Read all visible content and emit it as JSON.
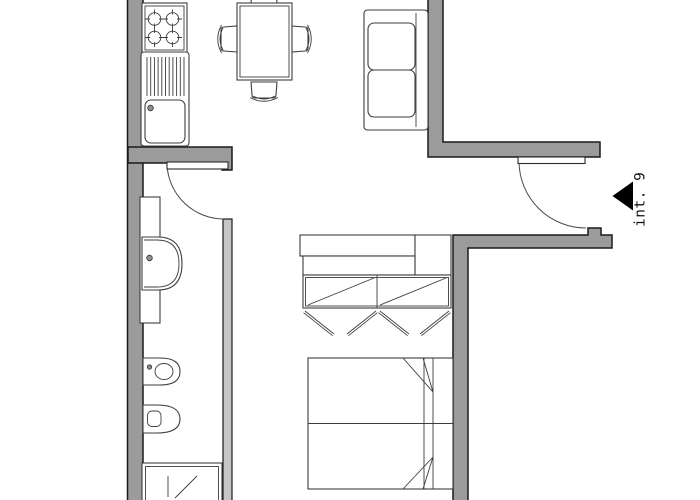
{
  "unit_label": {
    "text": "int. 9"
  },
  "colors": {
    "background": "#ffffff",
    "wall_fill": "#9b9b9b",
    "wall_outline": "#1a1a1a",
    "partition_fill": "#c6c6c6",
    "furniture_stroke": "#3d3d3d",
    "door_arc": "#4a4a4a",
    "entry_arrow": "#000000"
  },
  "plan": {
    "type": "apartment-floor-plan",
    "rooms": {
      "kitchen": {
        "fixtures": [
          "stove-4-burners",
          "sink-unit-with-drainboard"
        ]
      },
      "dining_area": {
        "fixtures": [
          "dining-table",
          "chair-top",
          "chair-left",
          "chair-right",
          "chair-bottom"
        ]
      },
      "living_area": {
        "fixtures": [
          "two-seat-sofa"
        ]
      },
      "bathroom": {
        "fixtures": [
          "counter",
          "washbasin",
          "bidet",
          "toilet",
          "shower-tray"
        ]
      },
      "bedroom": {
        "fixtures": [
          "low-bench",
          "wardrobe-with-open-doors",
          "double-bed"
        ]
      },
      "entry": {
        "fixtures": [
          "entry-door-swing",
          "entrance-arrow"
        ]
      }
    },
    "doors": [
      "entry-door",
      "bathroom-door"
    ]
  }
}
